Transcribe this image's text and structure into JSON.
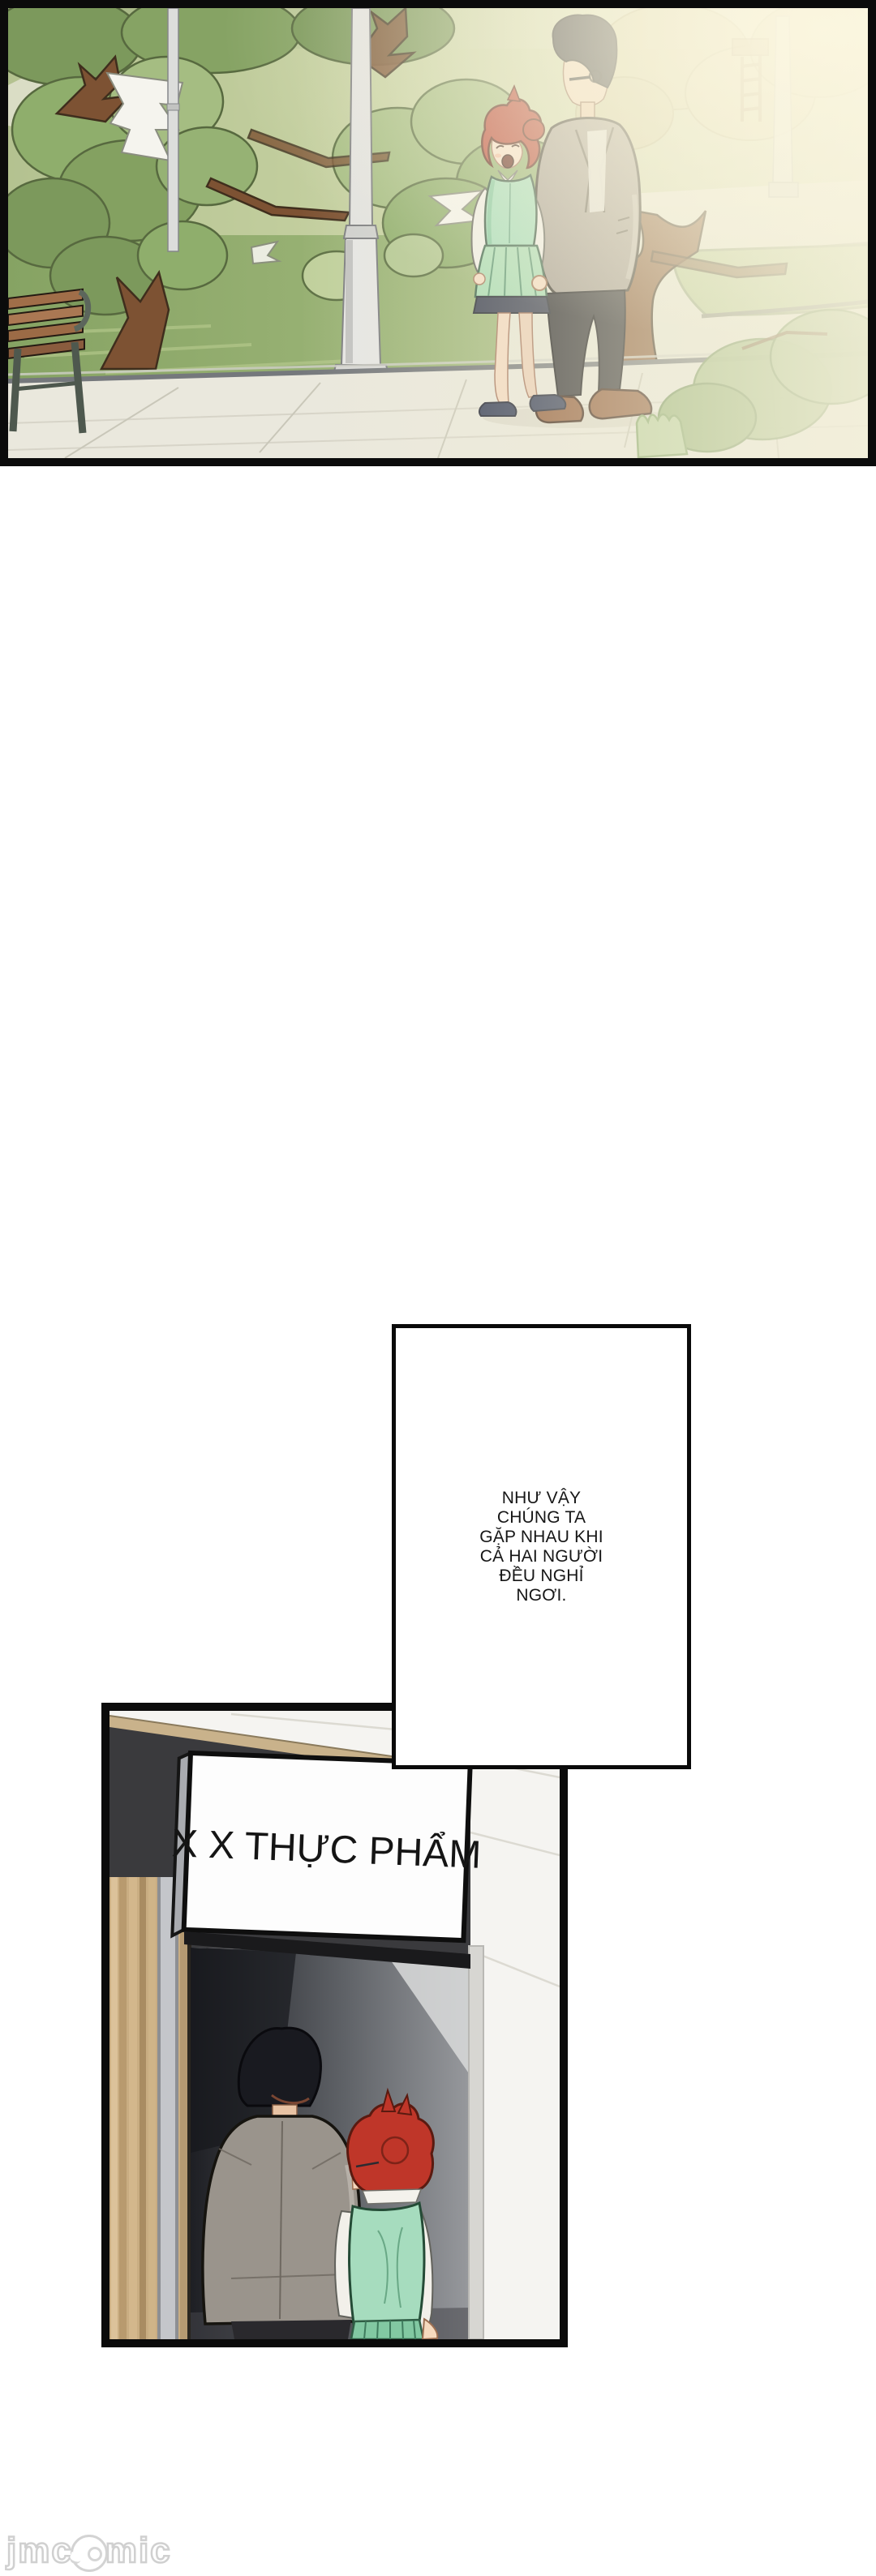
{
  "document": {
    "type": "comic-page",
    "language": "vi"
  },
  "panels": {
    "park": {
      "description": "Daytime park: red-haired woman in mint vest and green skirt walks hand in hand with tall man in gray blazer along a paved path; trees, wooden bench, lamp posts, hazy sunlight from the right."
    },
    "store": {
      "description": "Storefront entrance seen from behind: man in gray suit and red-haired woman in mint vest enter a dark doorway under a white shop sign.",
      "sign_text": "X X THỰC PHẨM"
    }
  },
  "speech": {
    "lines": [
      "NHƯ VẬY",
      "CHÚNG TA",
      "GẶP NHAU KHI",
      "CẢ HAI NGƯỜI",
      "ĐỀU NGHỈ",
      "NGƠI."
    ]
  },
  "watermark": {
    "prefix": "jmc",
    "suffix": "mic",
    "mascot": "bird-face-icon"
  },
  "palette": {
    "page_bg": "#ffffff",
    "panel_border": "#0b0b0b",
    "park_green": "#8fae6c",
    "park_haze": "#f2eed6",
    "pavement": "#eae8dd",
    "woman_hair": "#bf3629",
    "woman_vest": "#a6dcbe",
    "man_suit": "#9a948c",
    "store_fascia": "#3a3a3d",
    "wood_trim": "#c9b28b",
    "watermark_gray": "#cccccc"
  }
}
